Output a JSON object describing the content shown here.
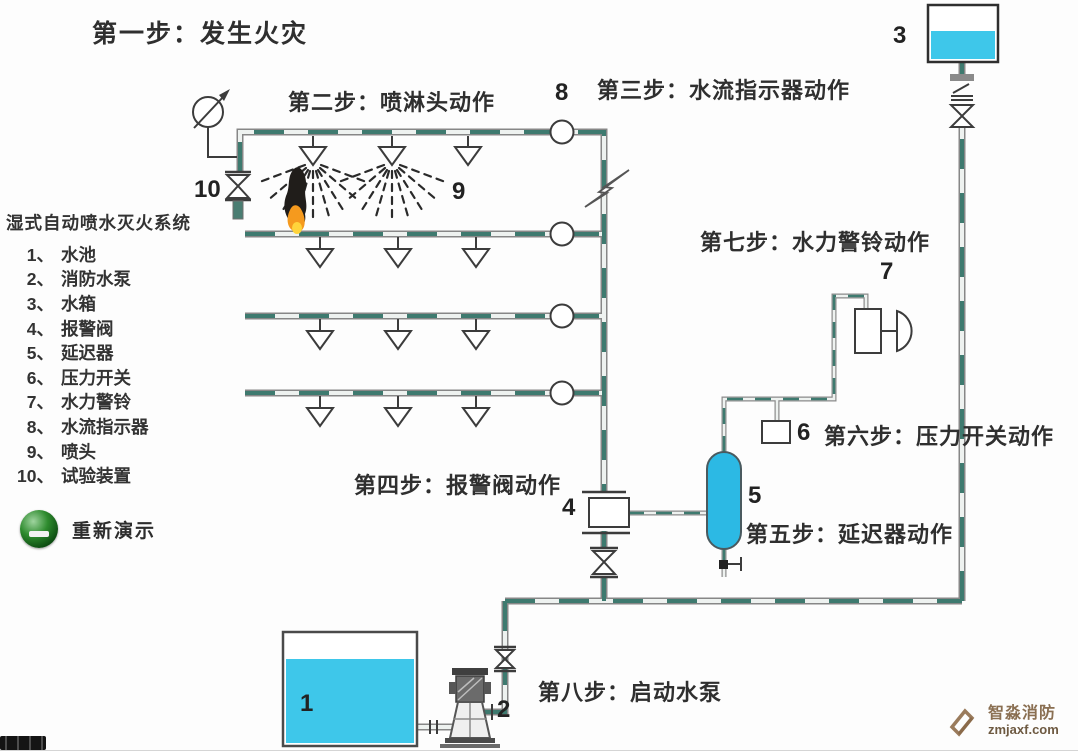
{
  "steps": {
    "s1": "第一步：发生火灾",
    "s2": "第二步：喷淋头动作",
    "s3": "第三步：水流指示器动作",
    "s4": "第四步：报警阀动作",
    "s5": "第五步：延迟器动作",
    "s6": "第六步：压力开关动作",
    "s7": "第七步：水力警铃动作",
    "s8": "第八步：启动水泵"
  },
  "legend": {
    "title": "湿式自动喷水灭火系统",
    "items": [
      {
        "n": "1、",
        "label": "水池"
      },
      {
        "n": "2、",
        "label": "消防水泵"
      },
      {
        "n": "3、",
        "label": "水箱"
      },
      {
        "n": "4、",
        "label": "报警阀"
      },
      {
        "n": "5、",
        "label": "延迟器"
      },
      {
        "n": "6、",
        "label": "压力开关"
      },
      {
        "n": "7、",
        "label": "水力警铃"
      },
      {
        "n": "8、",
        "label": "水流指示器"
      },
      {
        "n": "9、",
        "label": "喷头"
      },
      {
        "n": "10、",
        "label": "试验装置"
      }
    ]
  },
  "component_numbers": {
    "pool": "1",
    "pump": "2",
    "tank": "3",
    "alarm_valve": "4",
    "retarder": "5",
    "pressure_switch": "6",
    "alarm_bell": "7",
    "flow_indicator": "8",
    "sprinkler": "9",
    "test_device": "10"
  },
  "replay": {
    "label": "重新演示"
  },
  "watermark": {
    "brand": "智淼消防",
    "site": "zmjaxf.com"
  },
  "icons": {
    "replay": "green-sphere-button",
    "watermark_logo": "diamond-z-logo",
    "gauge": "pressure-gauge",
    "bell": "alarm-bell",
    "fire": "flame-with-smoke"
  },
  "colors": {
    "tank_water": "#3ec7ea",
    "retarder_fill": "#2cb9e4",
    "pipe_gray": "#878787",
    "pipe_water_teal": "#3e7a6f",
    "fire_orange": "#f59a1e",
    "fire_yellow": "#ffd43b",
    "smoke": "#201d1a",
    "replay_green": "#1e7a1e",
    "watermark_tan": "#9a7b5c"
  }
}
